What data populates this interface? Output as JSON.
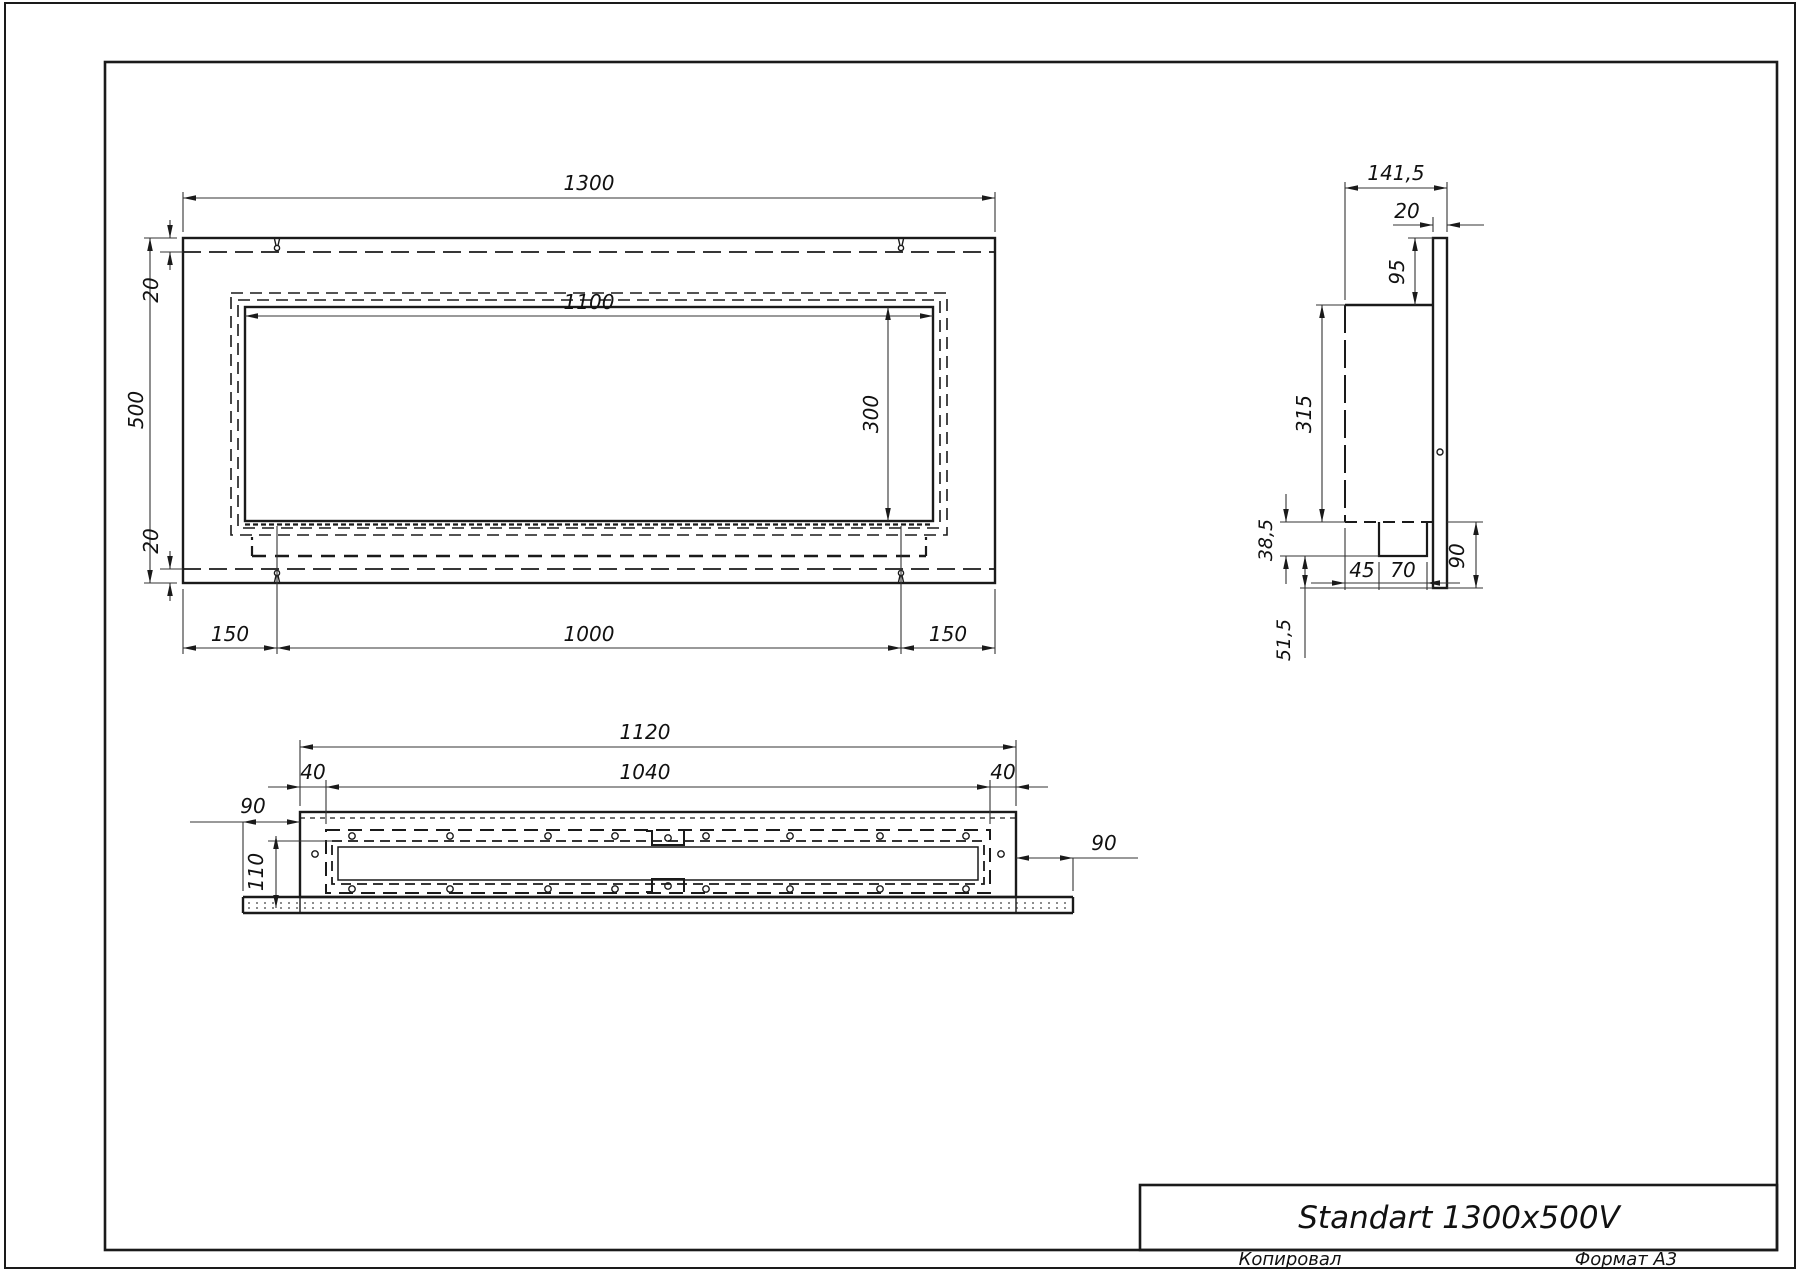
{
  "title_block": {
    "title": "Standart 1300x500V",
    "copied_by": "Копировал",
    "format": "Формат А3"
  },
  "views": {
    "front": {
      "dims": {
        "overall_width": "1300",
        "overall_height": "500",
        "top_inset": "20",
        "bottom_inset": "20",
        "opening_width": "1100",
        "opening_height": "300",
        "left_offset": "150",
        "slot_spacing": "1000",
        "right_offset": "150"
      }
    },
    "side": {
      "dims": {
        "overall_depth": "141,5",
        "flange_thickness": "20",
        "top_extension": "95",
        "body_height": "315",
        "tray_height": "38,5",
        "tray_offset": "45",
        "tray_width": "70",
        "bottom_extension": "90",
        "bottom_offset": "51,5"
      }
    },
    "plan": {
      "dims": {
        "box_width": "1120",
        "inner_width": "1040",
        "left_inset": "40",
        "right_inset": "40",
        "left_overhang": "90",
        "depth": "110",
        "right_overhang": "90"
      }
    }
  }
}
